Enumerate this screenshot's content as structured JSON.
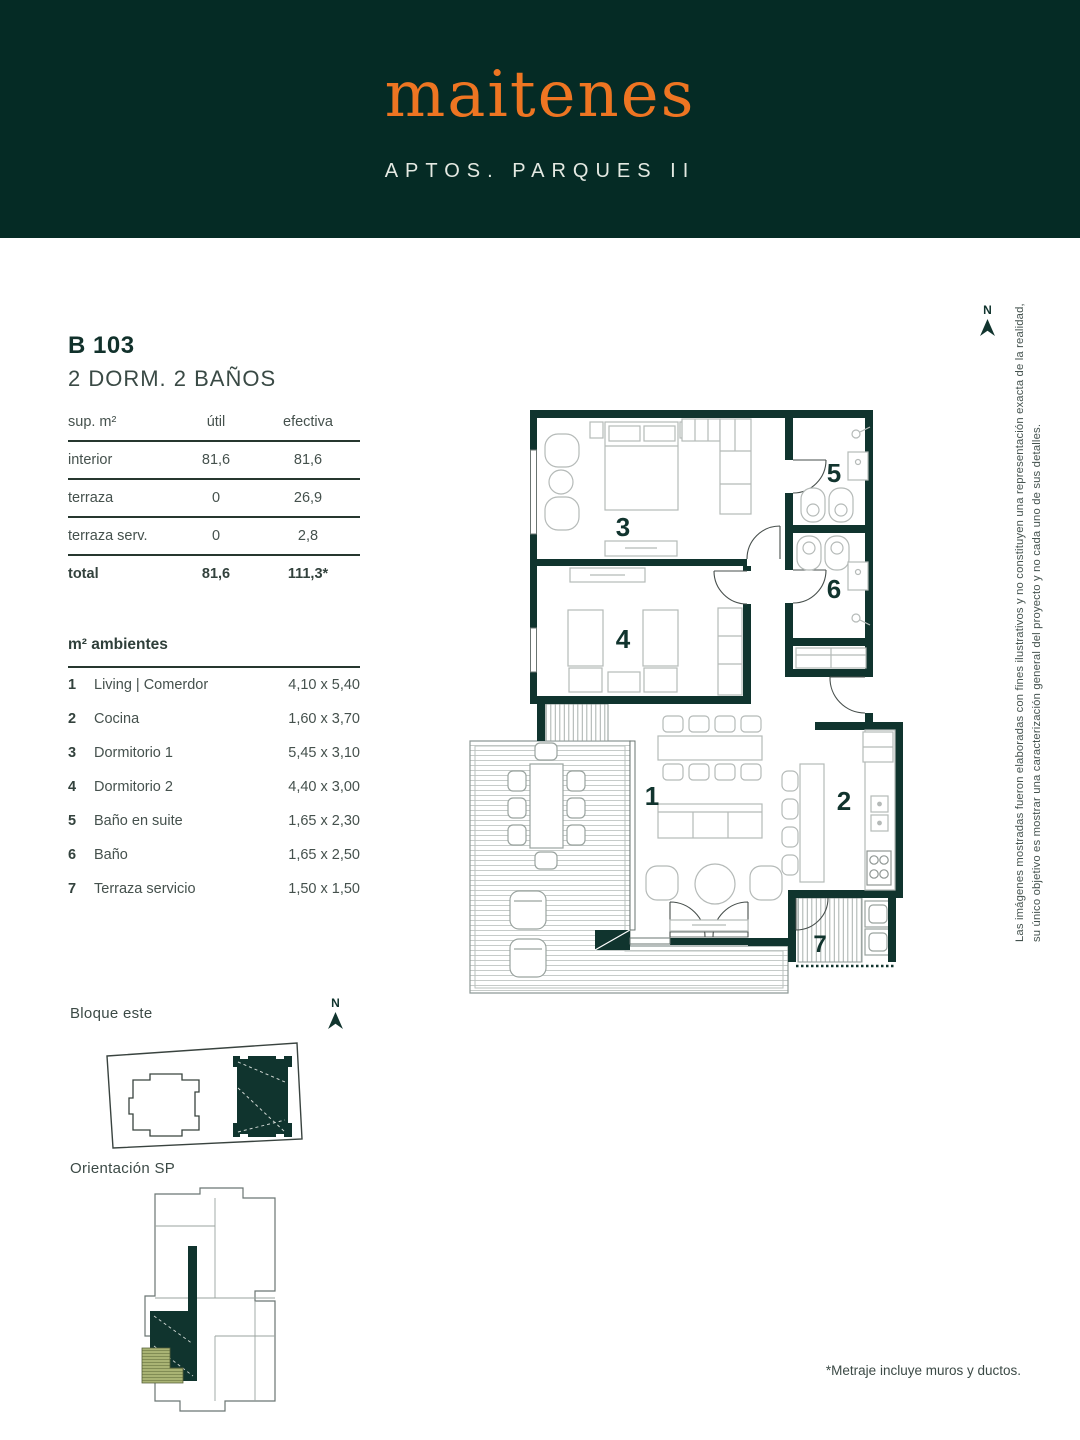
{
  "header": {
    "logo": "maitenes",
    "subtitle": "APTOS. PARQUES II"
  },
  "unit": {
    "code": "B 103",
    "type": "2 DORM. 2 BAÑOS"
  },
  "surface_table": {
    "headers": {
      "col1": "sup. m²",
      "col2": "útil",
      "col3": "efectiva"
    },
    "rows": [
      {
        "label": "interior",
        "util": "81,6",
        "efectiva": "81,6"
      },
      {
        "label": "terraza",
        "util": "0",
        "efectiva": "26,9"
      },
      {
        "label": "terraza serv.",
        "util": "0",
        "efectiva": "2,8"
      }
    ],
    "total": {
      "label": "total",
      "util": "81,6",
      "efectiva": "111,3*"
    }
  },
  "ambientes": {
    "title": "m² ambientes",
    "items": [
      {
        "num": "1",
        "name": "Living | Comerdor",
        "dims": "4,10 x 5,40"
      },
      {
        "num": "2",
        "name": "Cocina",
        "dims": "1,60 x 3,70"
      },
      {
        "num": "3",
        "name": "Dormitorio 1",
        "dims": "5,45 x 3,10"
      },
      {
        "num": "4",
        "name": "Dormitorio 2",
        "dims": "4,40 x 3,00"
      },
      {
        "num": "5",
        "name": "Baño en suite",
        "dims": "1,65 x 2,30"
      },
      {
        "num": "6",
        "name": "Baño",
        "dims": "1,65 x 2,50"
      },
      {
        "num": "7",
        "name": "Terraza servicio",
        "dims": "1,50 x 1,50"
      }
    ]
  },
  "plan": {
    "north": "N",
    "labels": {
      "living": "1",
      "cocina": "2",
      "dorm1": "3",
      "dorm2": "4",
      "banio_suite": "5",
      "banio": "6",
      "terraza_serv": "7"
    }
  },
  "site": {
    "label": "Bloque este",
    "north": "N"
  },
  "orientation": {
    "label": "Orientación SP"
  },
  "disclaimer": "Las imágenes mostradas fueron elaboradas con fines ilustrativos y no constituyen una representación exacta de la realidad, su único objetivo es mostrar una caracterización general del proyecto y no cada uno de sus detalles.",
  "footnote": "*Metraje incluye muros y ductos.",
  "colors": {
    "brand_green": "#052b25",
    "wall_green": "#10342e",
    "accent_orange": "#ee7522",
    "olive": "#a9b374"
  }
}
